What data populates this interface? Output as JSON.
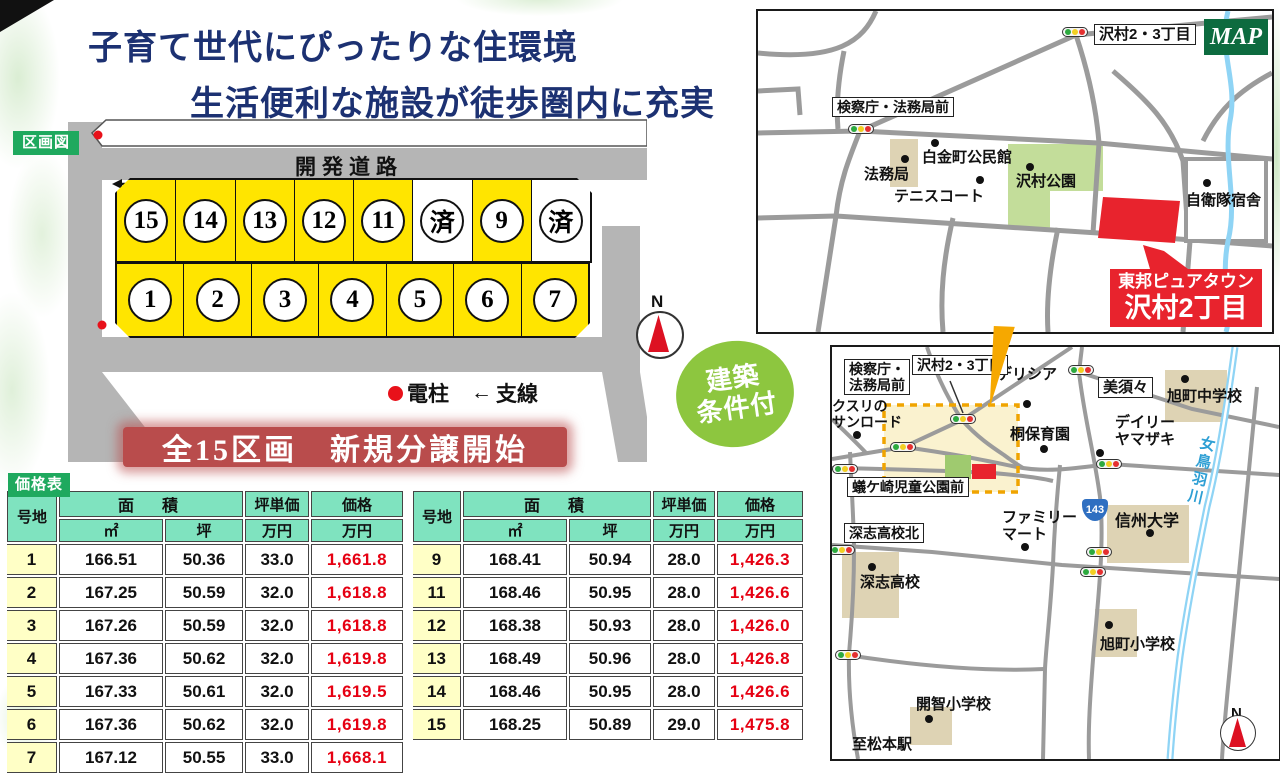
{
  "header": {
    "title_line1": "子育て世代にぴったりな住環境",
    "title_line2": "生活便利な施設が徒歩圏内に充実"
  },
  "plot_map": {
    "badge": "区画図",
    "road_label": "開発道路",
    "lots_top": [
      "15",
      "14",
      "13",
      "12",
      "11",
      "済",
      "9",
      "済"
    ],
    "lots_bottom": [
      "1",
      "2",
      "3",
      "4",
      "5",
      "6",
      "7"
    ],
    "legend": {
      "pole_dot": "●",
      "pole": "電柱",
      "wire_arrow": "←",
      "wire": "支線"
    },
    "compass_n": "N"
  },
  "sale_banner": "全15区画　新規分譲開始",
  "condition_badge": {
    "line1": "建築",
    "line2": "条件付"
  },
  "price": {
    "badge": "価格表",
    "headers": {
      "lot": "号地",
      "area": "面　積",
      "sqm": "㎡",
      "tsubo": "坪",
      "unit": "坪単価",
      "man_yen": "万円",
      "price": "価格"
    },
    "left": [
      {
        "lot": "1",
        "sqm": "166.51",
        "tsubo": "50.36",
        "unit": "33.0",
        "price": "1,661.8"
      },
      {
        "lot": "2",
        "sqm": "167.25",
        "tsubo": "50.59",
        "unit": "32.0",
        "price": "1,618.8"
      },
      {
        "lot": "3",
        "sqm": "167.26",
        "tsubo": "50.59",
        "unit": "32.0",
        "price": "1,618.8"
      },
      {
        "lot": "4",
        "sqm": "167.36",
        "tsubo": "50.62",
        "unit": "32.0",
        "price": "1,619.8"
      },
      {
        "lot": "5",
        "sqm": "167.33",
        "tsubo": "50.61",
        "unit": "32.0",
        "price": "1,619.5"
      },
      {
        "lot": "6",
        "sqm": "167.36",
        "tsubo": "50.62",
        "unit": "32.0",
        "price": "1,619.8"
      },
      {
        "lot": "7",
        "sqm": "167.12",
        "tsubo": "50.55",
        "unit": "33.0",
        "price": "1,668.1"
      }
    ],
    "right": [
      {
        "lot": "9",
        "sqm": "168.41",
        "tsubo": "50.94",
        "unit": "28.0",
        "price": "1,426.3"
      },
      {
        "lot": "11",
        "sqm": "168.46",
        "tsubo": "50.95",
        "unit": "28.0",
        "price": "1,426.6"
      },
      {
        "lot": "12",
        "sqm": "168.38",
        "tsubo": "50.93",
        "unit": "28.0",
        "price": "1,426.0"
      },
      {
        "lot": "13",
        "sqm": "168.49",
        "tsubo": "50.96",
        "unit": "28.0",
        "price": "1,426.8"
      },
      {
        "lot": "14",
        "sqm": "168.46",
        "tsubo": "50.95",
        "unit": "28.0",
        "price": "1,426.6"
      },
      {
        "lot": "15",
        "sqm": "168.25",
        "tsubo": "50.89",
        "unit": "29.0",
        "price": "1,475.8"
      }
    ]
  },
  "map_top": {
    "badge": "MAP",
    "signal_sawamura": "沢村2・3丁目",
    "signal_kensatsu": "検察庁・法務局前",
    "poi_homukyoku": "法務局",
    "poi_kominkan": "白金町公民館",
    "poi_tennis": "テニスコート",
    "poi_park": "沢村公園",
    "poi_jieitai": "自衛隊宿舎",
    "site_banner_line1": "東邦ピュアタウン",
    "site_banner_line2": "沢村2丁目"
  },
  "map_bottom": {
    "box_kensatsu_l1": "検察庁・",
    "box_kensatsu_l2": "法務局前",
    "box_sawamura": "沢村2・3丁目",
    "box_misuzu": "美須々",
    "box_arigasaki": "蟻ケ崎児童公園前",
    "box_fukashi_kita": "深志高校北",
    "poi_delicia": "デリシア",
    "poi_asahi_jhs": "旭町中学校",
    "poi_kusuri_l1": "クスリの",
    "poi_kusuri_l2": "サンロード",
    "poi_kiri": "桐保育園",
    "poi_daily_l1": "デイリー",
    "poi_daily_l2": "ヤマザキ",
    "poi_family_l1": "ファミリー",
    "poi_family_l2": "マート",
    "poi_shinshu": "信州大学",
    "poi_fukashi": "深志高校",
    "poi_asahi_es": "旭町小学校",
    "poi_kaichi": "開智小学校",
    "poi_matsumoto": "至松本駅",
    "river": "女鳥羽川",
    "route_number": "143",
    "compass_n": "N"
  }
}
